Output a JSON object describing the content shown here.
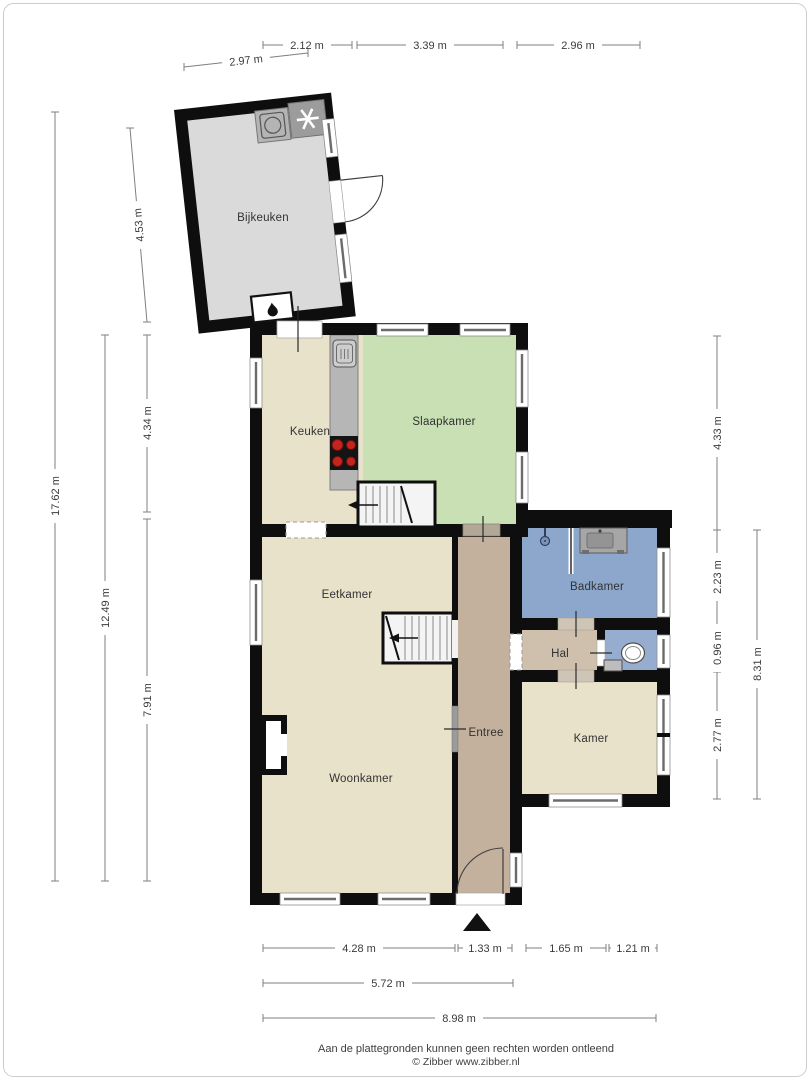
{
  "rooms": {
    "bijkeuken": "Bijkeuken",
    "keuken": "Keuken",
    "slaapkamer": "Slaapkamer",
    "eetkamer": "Eetkamer",
    "woonkamer": "Woonkamer",
    "entree": "Entree",
    "badkamer": "Badkamer",
    "hal": "Hal",
    "kamer": "Kamer"
  },
  "dimensions": {
    "top": {
      "d1": "2.12 m",
      "d2": "3.39 m",
      "d3": "2.96 m"
    },
    "bijkeuken": {
      "width": "2.97 m",
      "height": "4.53 m"
    },
    "left": {
      "total": "17.62 m",
      "main": "12.49 m",
      "upper": "4.34 m",
      "lower": "7.91 m"
    },
    "right": {
      "upper": "4.33 m",
      "badkamer": "2.23 m",
      "hal": "0.96 m",
      "kamer": "2.77 m",
      "total": "8.31 m"
    },
    "bottom": {
      "d1": "4.28 m",
      "d2": "1.33 m",
      "d3": "1.65 m",
      "d4": "1.21 m",
      "mid": "5.72 m",
      "total": "8.98 m"
    }
  },
  "footer": {
    "disclaimer": "Aan de plattegronden kunnen geen rechten worden ontleend",
    "credit": "© Zibber www.zibber.nl"
  },
  "colors": {
    "wall": "#0e0e0e",
    "bijkeuken_floor": "#dadada",
    "living_floor": "#e9e2cb",
    "bedroom_floor": "#c8e0b4",
    "bath_floor": "#8da7cc",
    "toilet_floor": "#97add0",
    "entree_floor": "#c3b19e",
    "hal_floor": "#cfc0ad",
    "counter": "#b6b6b6",
    "burner": "#c3241d"
  }
}
